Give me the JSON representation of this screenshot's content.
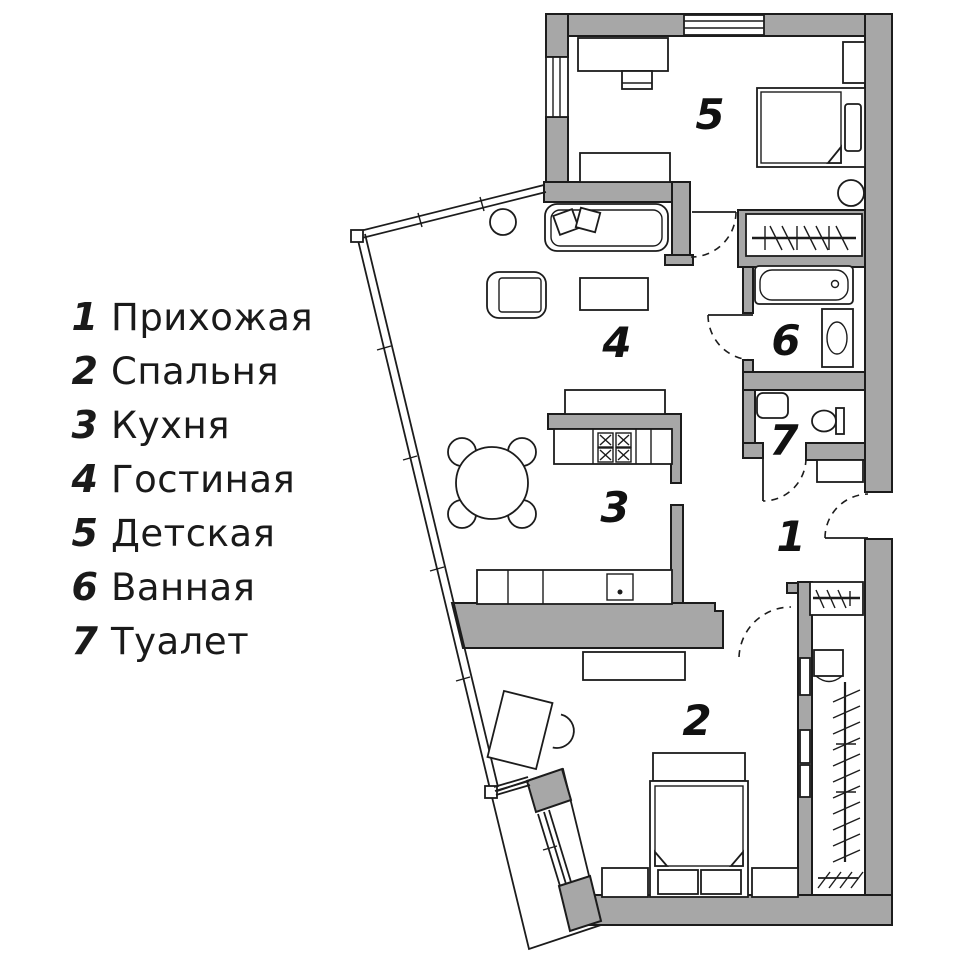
{
  "legend": {
    "items": [
      {
        "num": "1",
        "label": "Прихожая"
      },
      {
        "num": "2",
        "label": "Спальня"
      },
      {
        "num": "3",
        "label": "Кухня"
      },
      {
        "num": "4",
        "label": "Гостиная"
      },
      {
        "num": "5",
        "label": "Детская"
      },
      {
        "num": "6",
        "label": "Ванная"
      },
      {
        "num": "7",
        "label": "Туалет"
      }
    ]
  },
  "plan": {
    "room_numbers": [
      {
        "num": "1"
      },
      {
        "num": "2"
      },
      {
        "num": "3"
      },
      {
        "num": "4"
      },
      {
        "num": "5"
      },
      {
        "num": "6"
      },
      {
        "num": "7"
      }
    ]
  },
  "colors": {
    "wall_gray": "#a7a7a7",
    "line_black": "#1c1c1c",
    "background": "#ffffff"
  }
}
